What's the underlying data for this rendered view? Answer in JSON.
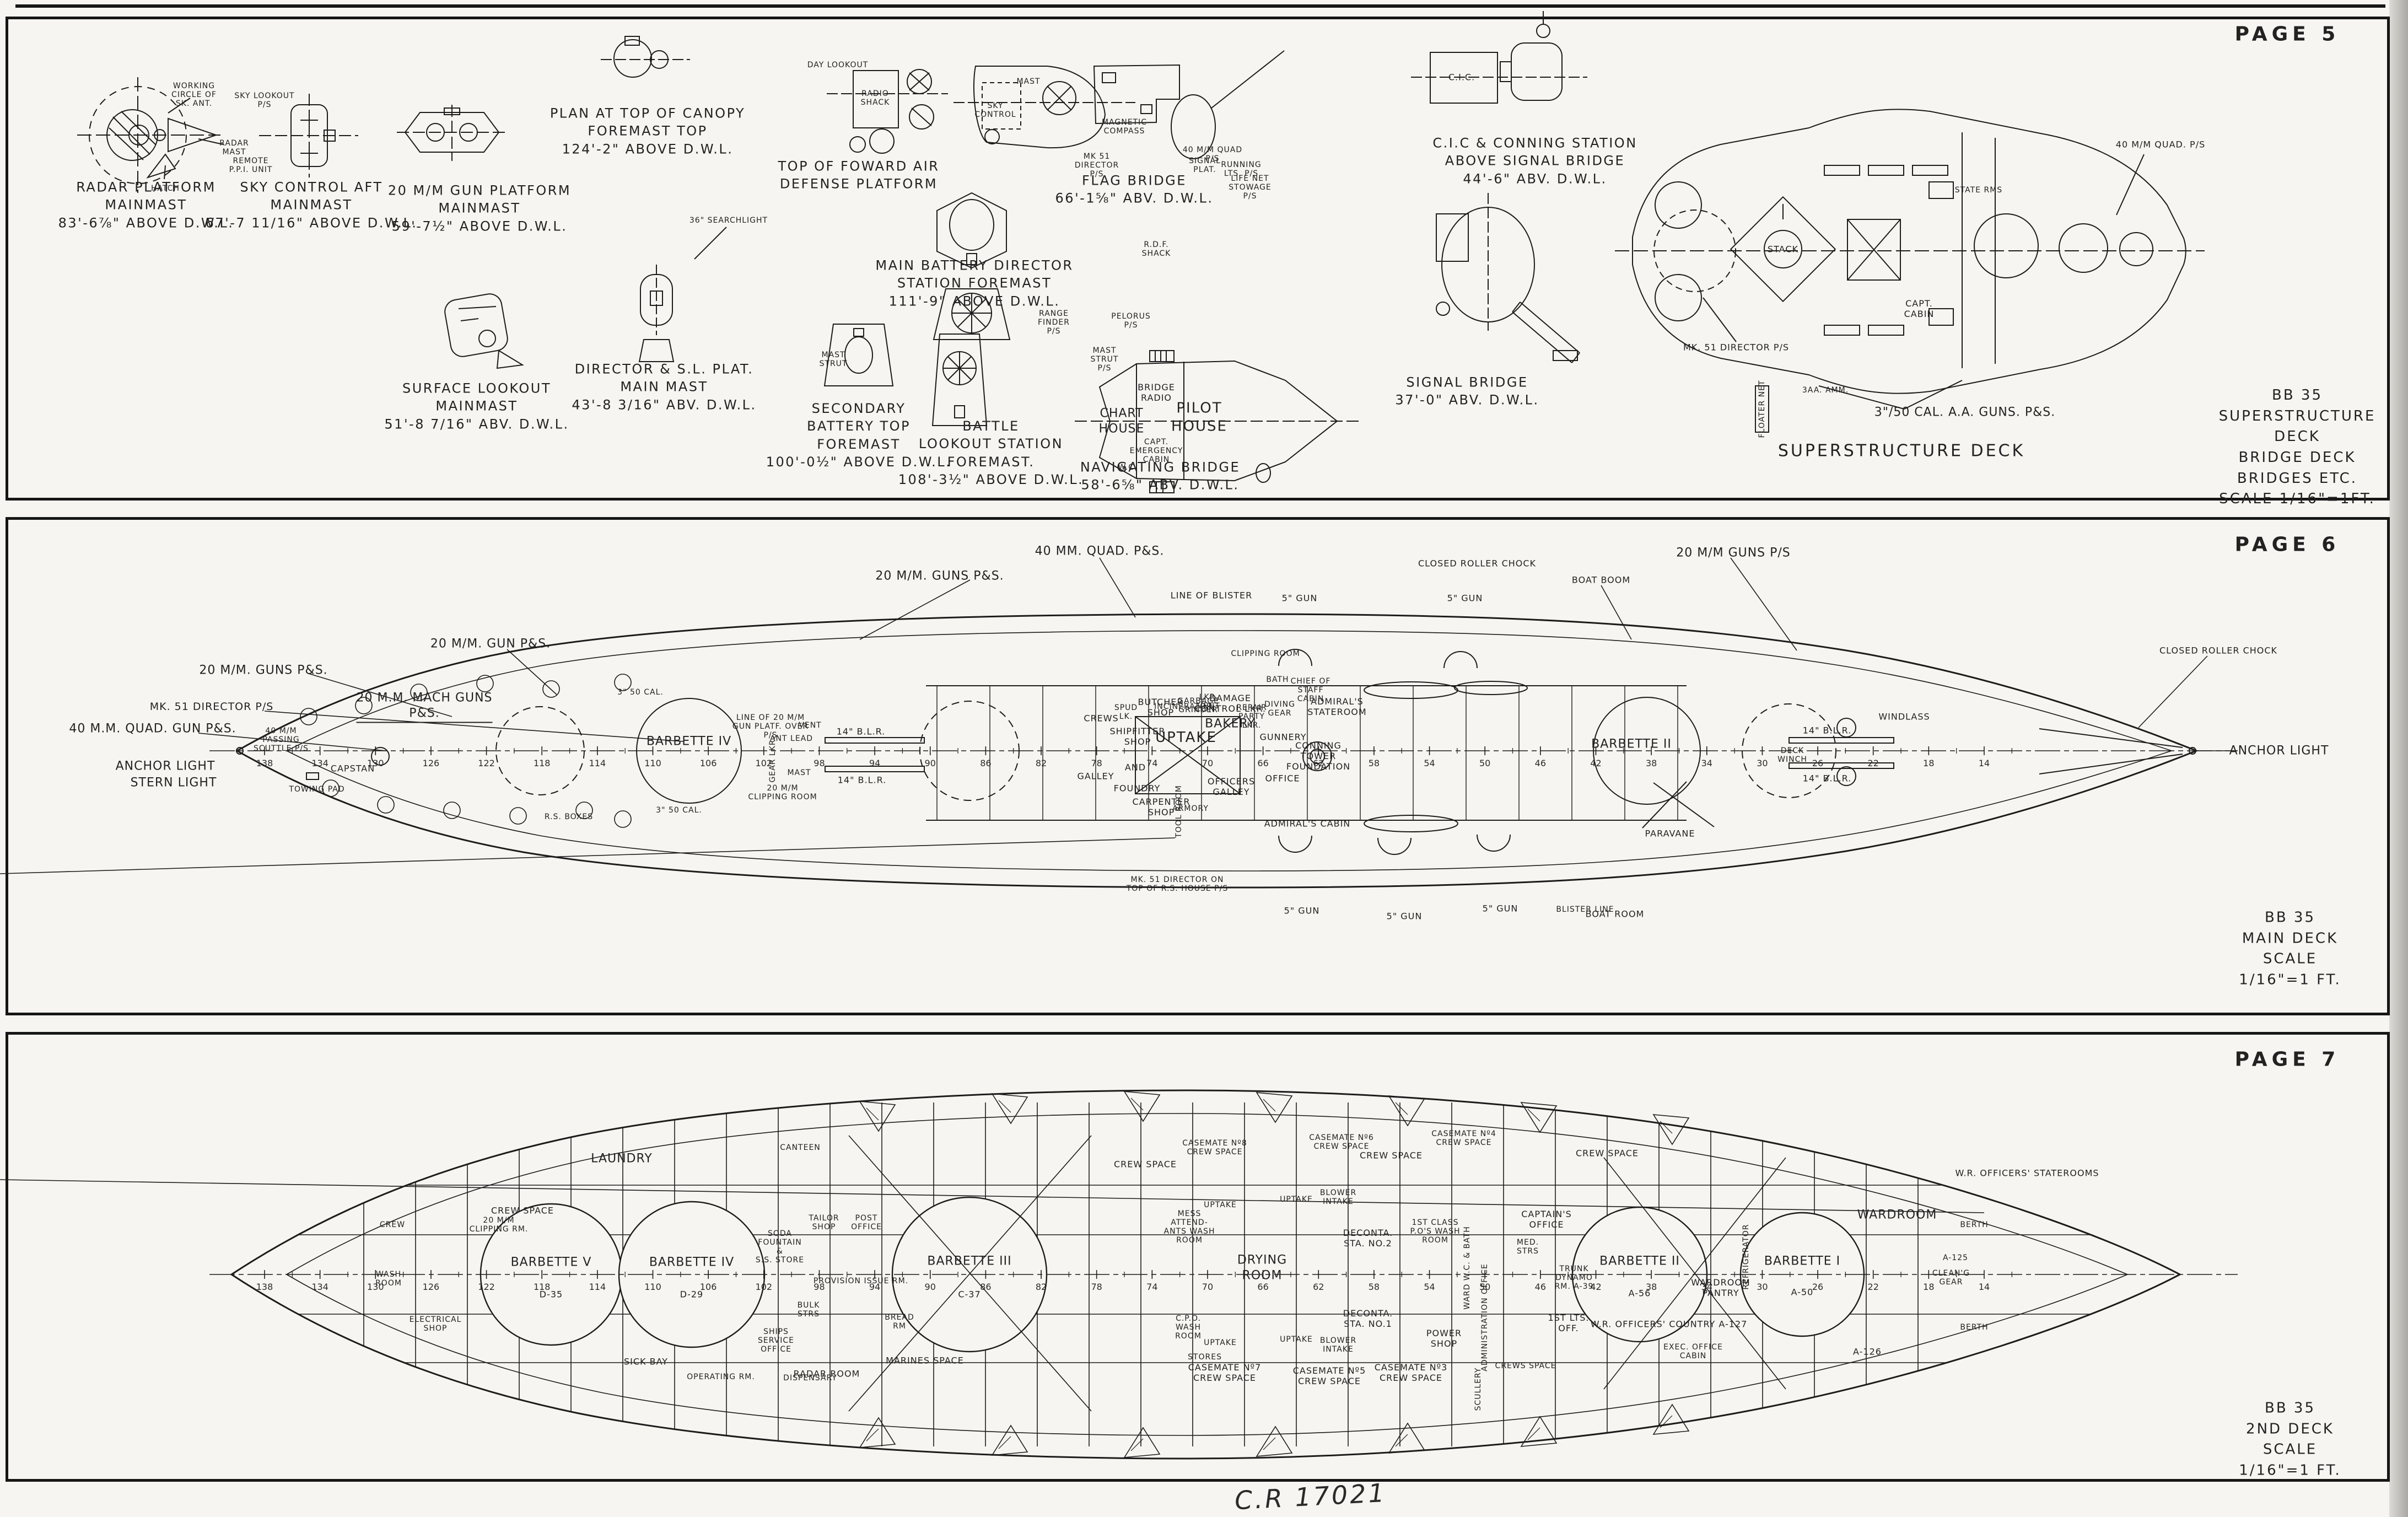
{
  "page5": {
    "page_label": "PAGE 5",
    "captions": {
      "radar_platform": "RADAR PLATFORM\nMAINMAST\n83'-6⅞\" ABOVE D.W.L.",
      "sky_control_aft": "SKY CONTROL AFT\nMAINMAST\n67'-7 11/16\" ABOVE D.W.L.",
      "gun_platform_20mm": "20 M/M GUN PLATFORM\nMAINMAST\n59'-7½\" ABOVE D.W.L.",
      "canopy_plan": "PLAN AT TOP OF CANOPY\nFOREMAST TOP\n124'-2\" ABOVE D.W.L.",
      "top_fwd_air_defense": "TOP OF FOWARD AIR\nDEFENSE PLATFORM",
      "fwd_air_defense": "FOWARD AIR DEFENSE\nPLATFORM",
      "flag_bridge": "FLAG BRIDGE\n66'-1⅝\" ABV. D.W.L.",
      "cic_conning": "C.I.C & CONNING STATION\nABOVE SIGNAL BRIDGE\n44'-6\" ABV. D.W.L.",
      "main_battery_director": "MAIN BATTERY DIRECTOR\nSTATION FOREMAST\n111'-9\" ABOVE D.W.L.",
      "director_sl_plat": "DIRECTOR & S.L. PLAT.\nMAIN MAST\n43'-8 3/16\" ABV. D.W.L.",
      "surface_lookout": "SURFACE LOOKOUT\nMAINMAST\n51'-8 7/16\" ABV. D.W.L.",
      "secondary_battery_top": "SECONDARY\nBATTERY TOP\nFOREMAST\n100'-0½\" ABOVE D.W.L.",
      "battle_lookout": "BATTLE\nLOOKOUT STATION\nFOREMAST.\n108'-3½\" ABOVE D.W.L.",
      "navigating_bridge": "NAVIGATING BRIDGE\n58'-6⅝\" ABV. D.W.L.",
      "signal_bridge": "SIGNAL BRIDGE\n37'-0\" ABV. D.W.L.",
      "superstructure_deck": "SUPERSTRUCTURE DECK"
    },
    "annotations": {
      "working_circle": "WORKING\nCIRCLE OF\nSK. ANT.",
      "radar_mast": "RADAR\nMAST",
      "hatch": "HATCH",
      "sky_lookout": "SKY LOOKOUT\nP/S",
      "remote_ppi": "REMOTE\nP.P.I. UNIT",
      "day_lookout": "DAY LOOKOUT",
      "radio_shack": "RADIO\nSHACK",
      "sky_control": "SKY\nCONTROL",
      "mast": "MAST",
      "mk51_director": "MK 51\nDIRECTOR\nP/S",
      "magnetic_compass": "MAGNETIC\nCOMPASS",
      "searchlight_36": "36\" SEARCHLIGHT",
      "rdf_shack": "R.D.F.\nSHACK",
      "range_finder": "RANGE\nFINDER\nP/S",
      "pelorus": "PELORUS\nP/S",
      "quad_40mm": "40 M/M QUAD\nP/S",
      "life_net": "LIFE NET\nSTOWAGE\nP/S",
      "signal_plat": "SIGNAL\nPLAT.",
      "running_lts": "RUNNING\nLTS. P/S",
      "cic_box": "C.I.C.",
      "chart_house": "CHART\nHOUSE",
      "pilot_house": "PILOT\nHOUSE",
      "bridge_radio": "BRIDGE\nRADIO",
      "capt_emergency_cabin": "CAPT.\nEMERGENCY\nCABIN",
      "wc": "W.C.",
      "mast_strut_ps": "MAST\nSTRUT\nP/S",
      "mast_strut": "MAST\nSTRUT",
      "stack": "STACK",
      "capt_cabin": "CAPT.\nCABIN",
      "state_rms": "STATE RMS",
      "quad_40mm_right": "40 M/M QUAD. P/S",
      "mk51_director_right": "MK. 51 DIRECTOR P/S",
      "guns_350": "3\"/50 CAL. A.A. GUNS. P&S.",
      "floater_net": "FLOATER NET",
      "amm_3aa": "3AA. AMM."
    },
    "title_block": {
      "ship": "BB 35",
      "line1": "SUPERSTRUCTURE DECK",
      "line2": "BRIDGE DECK  BRIDGES ETC.",
      "line3": "SCALE 1/16\"=1FT."
    }
  },
  "page6": {
    "page_label": "PAGE 6",
    "labels": {
      "quad_40_ps": "40 MM. QUAD. P&S.",
      "guns20_top": "20 M/M. GUNS P&S.",
      "gun20_top": "20 M/M. GUN P&S.",
      "mach_guns20": "20 M.M. MACH GUNS\nP&S.",
      "guns20_left": "20 M/M. GUNS P&S.",
      "mk51_left": "MK. 51 DIRECTOR P/S",
      "quad40_left": "40 M.M. QUAD. GUN  P&S.",
      "anchor_light_stern": "ANCHOR LIGHT",
      "stern_light": "STERN LIGHT",
      "passing_scuttle": "40 M/M\nPASSING\nSCUTTLE P/S",
      "towing_pad": "TOWING PAD",
      "capstan": "CAPSTAN",
      "line_of_blister": "LINE OF BLISTER",
      "gun5_t1": "5\" GUN",
      "gun5_t2": "5\" GUN",
      "gun5_b1": "5\" GUN",
      "gun5_b2": "5\" GUN",
      "gun5_b3": "5\" GUN",
      "boat_boom": "BOAT BOOM",
      "boat_room": "BOAT ROOM",
      "roller_chock_top": "CLOSED ROLLER CHOCK",
      "roller_chock_right": "CLOSED ROLLER CHOCK",
      "guns20_bow": "20 M/M GUNS P/S",
      "anchor_light_bow": "ANCHOR LIGHT",
      "crews": "CREWS",
      "galley": "GALLEY",
      "spud_lk": "SPUD\nLK.",
      "butcher_shop": "BUTCHER\nSHOP",
      "incinerator": "INCINERATOR",
      "garbage_grinder": "GARBAGE\nGRINDER",
      "lkr_vent": "LKR.\nVENT",
      "damage_control": "DAMAGE\nCONTROL LKR.",
      "bakery": "BAKERY",
      "repair_party": "REPAIR\nPARTY\nLKR.",
      "shipfitter": "SHIPFITTER\nSHOP",
      "and": "AND",
      "foundry": "FOUNDRY",
      "uptake": "UPTAKE",
      "officers_galley": "OFFICERS\nGALLEY",
      "carpenter": "CARPENTER\nSHOP",
      "tool_room": "TOOL ROOM",
      "armory": "ARMORY",
      "gunnery": "GUNNERY",
      "office": "OFFICE",
      "conning_foundation": "CONNING\nTOWER\nFOUNDATION",
      "admirals_stateroom": "ADMIRAL'S\nSTATEROOM",
      "chief_staff": "CHIEF OF\nSTAFF\nCABIN",
      "admirals_cabin": "ADMIRAL'S CABIN",
      "bath": "BATH",
      "diving_gear": "DIVING\nGEAR",
      "barbette_iv": "BARBETTE IV",
      "barbette_ii": "BARBETTE II",
      "line_20mm_platf": "LINE OF 20 M/M\nGUN PLATF. OVER\nP/S",
      "blr14_a": "14\" B.L.R.",
      "blr14_b": "14\" B.L.R.",
      "blr14_c": "14\" B.L.R.",
      "blr14_d": "14\" B.L.R.",
      "windlass": "WINDLASS",
      "deck_winch": "DECK\nWINCH",
      "paravane": "PARAVANE",
      "gear_lkr": "GEAR LKR.",
      "ant_lead": "ANT LEAD",
      "vent": "VENT",
      "mast": "MAST",
      "clipping_room_top": "CLIPPING ROOM",
      "clipping_room_bot": "20 M/M\nCLIPPING ROOM",
      "cal350_a": "3\" 50 CAL.",
      "cal350_b": "3\" 50 CAL.",
      "rs_boxes": "R.S. BOXES",
      "mk51_rs_house": "MK. 51 DIRECTOR ON\nTOP OF R.S. HOUSE P/S",
      "blister_line": "BLISTER LINE"
    },
    "frame_numbers": [
      "138",
      "134",
      "130",
      "126",
      "122",
      "118",
      "114",
      "110",
      "106",
      "102",
      "98",
      "94",
      "90",
      "86",
      "82",
      "78",
      "74",
      "70",
      "66",
      "62",
      "58",
      "54",
      "50",
      "46",
      "42",
      "38",
      "34",
      "30",
      "26",
      "22",
      "18",
      "14"
    ],
    "title_block": {
      "ship": "BB 35",
      "line1": "MAIN DECK",
      "line2": "SCALE 1/16\"=1 FT."
    }
  },
  "page7": {
    "page_label": "PAGE 7",
    "labels": {
      "laundry": "LAUNDRY",
      "canteen": "CANTEEN",
      "crew_space_a": "CREW SPACE",
      "crew_space_b": "CREW SPACE",
      "crew_space_c": "CREW SPACE",
      "crew_space_d": "CREW SPACE",
      "casemate8": "CASEMATE Nº8\nCREW SPACE",
      "casemate6": "CASEMATE Nº6\nCREW SPACE",
      "casemate4": "CASEMATE Nº4\nCREW SPACE",
      "casemate7": "CASEMATE Nº7\nCREW SPACE",
      "casemate5": "CASEMATE Nº5\nCREW SPACE",
      "casemate3": "CASEMATE Nº3\nCREW SPACE",
      "marines_space": "MARINES  SPACE",
      "sick_bay": "SICK BAY",
      "operating_rm": "OPERATING RM.",
      "dispensary": "DISPENSARY",
      "tailor_shop": "TAILOR\nSHOP",
      "post_office": "POST\nOFFICE",
      "soda_fountain": "SODA\nFOUNTAIN\n&\nS.S. STORE",
      "provision_issue": "PROVISION ISSUE RM.",
      "bulk_strs": "BULK\nSTRS",
      "ships_service": "SHIPS\nSERVICE\nOFFICE",
      "radar_room": "RADAR  ROOM",
      "bread_rm": "BREAD\nRM",
      "barbette5": "BARBETTE V",
      "barbette5_no": "D-35",
      "barbette4": "BARBETTE IV",
      "barbette4_no": "D-29",
      "barbette3": "BARBETTE III",
      "barbette3_no": "C-37",
      "barbette2": "BARBETTE II",
      "barbette2_no": "A-56",
      "barbette1": "BARBETTE I",
      "barbette1_no": "A-50",
      "wardroom_pantry": "WARDROOM\nPANTRY",
      "refrigerator": "REFRIGERATOR",
      "wardroom": "WARDROOM",
      "wr_staterooms": "W.R. OFFICERS' STATEROOMS",
      "wr_country": "W.R. OFFICERS' COUNTRY  A-127",
      "a126": "A-126",
      "a125": "A-125",
      "exec_office": "EXEC. OFFICE\nCABIN",
      "captains_office": "CAPTAIN'S\nOFFICE",
      "drying_room": "DRYING\nROOM",
      "deconta2": "DECONTA.\nSTA. NO.2",
      "deconta1": "DECONTA.\nSTA. NO.1",
      "wash_1st_class": "1ST CLASS\nP.O'S WASH\nROOM",
      "ward_wc_bath": "WARD W.C. & BATH",
      "power_shop": "POWER\nSHOP",
      "administration": "ADMINISTRATION OFFICE",
      "mess_attendants": "MESS\nATTEND-\nANTS WASH\nROOM",
      "cpo_wash": "C.P.O.\nWASH\nROOM",
      "stores": "STORES",
      "uptake_a": "UPTAKE",
      "uptake_b": "UPTAKE",
      "uptake_c": "UPTAKE",
      "uptake_d": "UPTAKE",
      "blower_intake_a": "BLOWER\nINTAKE",
      "blower_intake_b": "BLOWER\nINTAKE",
      "med_strs": "MED.\nSTRS",
      "trunk_dynamo": "TRUNK\nDYNAMO\nRM. A-39",
      "first_lts": "1ST LTS.\nOFF.",
      "crews_space": "CREWS  SPACE",
      "scullery": "SCULLERY",
      "cleaning_gear": "CLEAN'G\nGEAR",
      "berth_a": "BERTH",
      "berth_b": "BERTH",
      "clipping_rm": "20 M/M\nCLIPPING RM.",
      "crew_stern": "CREW",
      "wash_room_stern": "WASH\nROOM",
      "electrical_shop": "ELECTRICAL\nSHOP"
    },
    "frame_numbers": [
      "138",
      "134",
      "130",
      "126",
      "122",
      "118",
      "114",
      "110",
      "106",
      "102",
      "98",
      "94",
      "90",
      "86",
      "82",
      "78",
      "74",
      "70",
      "66",
      "62",
      "58",
      "54",
      "50",
      "46",
      "42",
      "38",
      "34",
      "30",
      "26",
      "22",
      "18",
      "14"
    ],
    "title_block": {
      "ship": "BB 35",
      "line1": "2ND DECK",
      "line2": "SCALE 1/16\"=1 FT."
    }
  },
  "footer": {
    "handwritten": "C.R  17021"
  }
}
